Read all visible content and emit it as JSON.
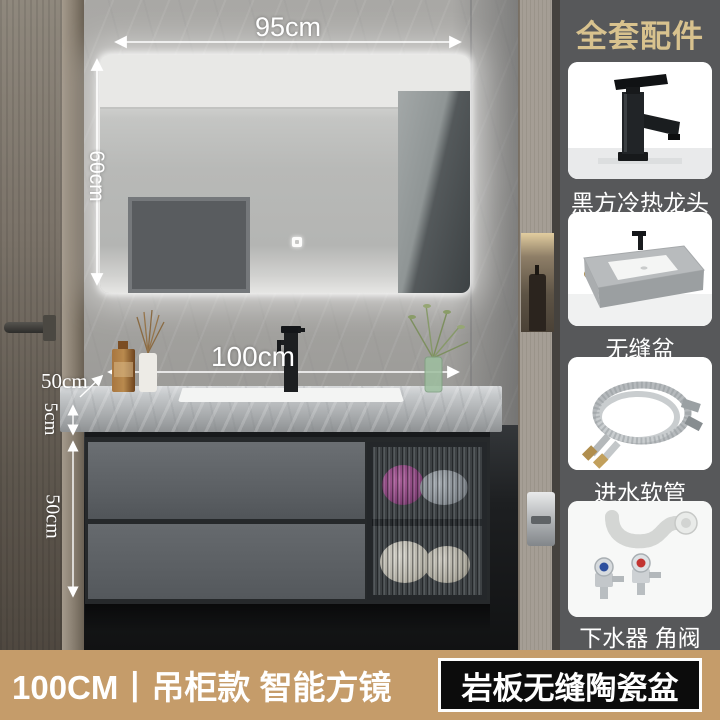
{
  "scene": {
    "dimensions": {
      "mirror_width": "95cm",
      "mirror_height": "60cm",
      "counter_width": "100cm",
      "counter_depth": "50cm",
      "counter_thickness": "5cm",
      "cabinet_height": "50cm"
    }
  },
  "sidebar": {
    "title": "全套配件",
    "items": [
      {
        "name": "faucet",
        "label": "黑方冷热龙头"
      },
      {
        "name": "basin",
        "label": "无缝盆"
      },
      {
        "name": "inlet-hose",
        "label": "进水软管"
      },
      {
        "name": "drain-and-valve",
        "label": "下水器 角阀"
      }
    ]
  },
  "footer": {
    "left_text": "100CM丨吊柜款 智能方镜",
    "badge_text": "岩板无缝陶瓷盆"
  },
  "colors": {
    "sidebar_bg": "#57585a",
    "sidebar_title": "#d8c28e",
    "card_label": "#ffffff",
    "footer_bar": "#c59c6a",
    "badge_bg": "#0c0c0c",
    "badge_border": "#ffffff",
    "dimension_text": "#ffffff"
  }
}
